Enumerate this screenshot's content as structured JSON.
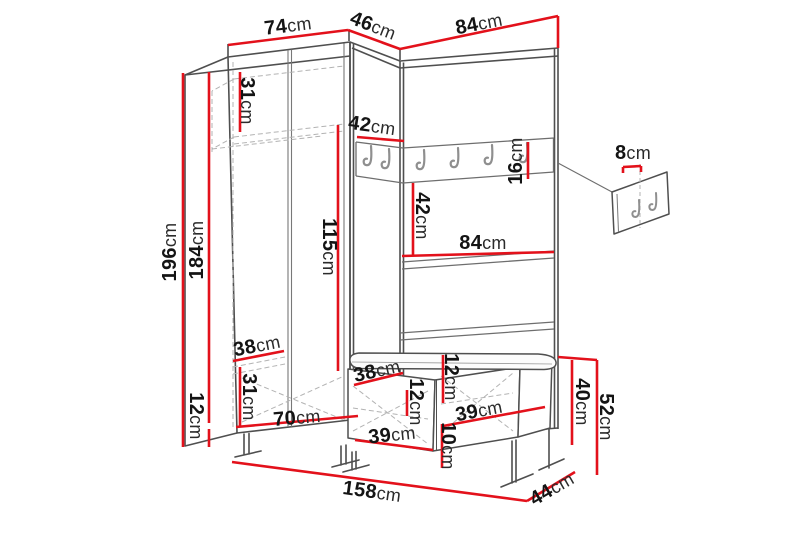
{
  "diagram": {
    "kind": "furniture-dimension-drawing",
    "subject": "hallway wardrobe set with coat rack, shelves and bench",
    "unit": "cm"
  },
  "colors": {
    "dimension_line": "#e3111b",
    "outline": "#4f4f4f",
    "inner_line": "#787878",
    "dashed_line": "#b3b3b3",
    "hook": "#8f8f8f",
    "label_text": "#141414",
    "background": "#ffffff"
  },
  "icons": {
    "coat_hook": "J-hook glyph",
    "rail_hook_count": 6,
    "wall_panel_hook_count": 2
  },
  "dimensions": [
    {
      "id": "wardrobe-width-top",
      "value": "74",
      "unit": "cm",
      "x": 288,
      "y": 26,
      "rot": -7
    },
    {
      "id": "corner-width-top",
      "value": "46",
      "unit": "cm",
      "x": 373,
      "y": 26,
      "rot": 21
    },
    {
      "id": "panel-width-top",
      "value": "84",
      "unit": "cm",
      "x": 479,
      "y": 24,
      "rot": -11
    },
    {
      "id": "upper-shelf-height",
      "value": "31",
      "unit": "cm",
      "x": 247,
      "y": 101,
      "rot": 90
    },
    {
      "id": "corner-rail-width",
      "value": "42",
      "unit": "cm",
      "x": 372,
      "y": 126,
      "rot": 8
    },
    {
      "id": "hook-rail-height",
      "value": "16",
      "unit": "cm",
      "x": 516,
      "y": 161,
      "rot": -90
    },
    {
      "id": "wall-panel-height",
      "value": "8",
      "unit": "cm",
      "x": 633,
      "y": 153,
      "rot": 0
    },
    {
      "id": "rail-to-shelf-height",
      "value": "42",
      "unit": "cm",
      "x": 422,
      "y": 216,
      "rot": 90
    },
    {
      "id": "shelf-width",
      "value": "84",
      "unit": "cm",
      "x": 483,
      "y": 243,
      "rot": 0
    },
    {
      "id": "hanging-space-height",
      "value": "115",
      "unit": "cm",
      "x": 329,
      "y": 247,
      "rot": 90
    },
    {
      "id": "total-height",
      "value": "196",
      "unit": "cm",
      "x": 170,
      "y": 252,
      "rot": -90
    },
    {
      "id": "body-height",
      "value": "184",
      "unit": "cm",
      "x": 197,
      "y": 250,
      "rot": -90
    },
    {
      "id": "wardrobe-shelf-depth",
      "value": "38",
      "unit": "cm",
      "x": 257,
      "y": 346,
      "rot": -11
    },
    {
      "id": "lower-compartment-height",
      "value": "31",
      "unit": "cm",
      "x": 249,
      "y": 397,
      "rot": 90
    },
    {
      "id": "wardrobe-inner-width",
      "value": "70",
      "unit": "cm",
      "x": 297,
      "y": 418,
      "rot": -5
    },
    {
      "id": "leg-height",
      "value": "12",
      "unit": "cm",
      "x": 196,
      "y": 416,
      "rot": 90
    },
    {
      "id": "bench-seat-depth",
      "value": "38",
      "unit": "cm",
      "x": 377,
      "y": 371,
      "rot": -13
    },
    {
      "id": "bench-top-height",
      "value": "12",
      "unit": "cm",
      "x": 451,
      "y": 377,
      "rot": 90
    },
    {
      "id": "bench-drawer-height",
      "value": "12",
      "unit": "cm",
      "x": 416,
      "y": 402,
      "rot": 90
    },
    {
      "id": "bench-door-right-width",
      "value": "39",
      "unit": "cm",
      "x": 479,
      "y": 411,
      "rot": -11
    },
    {
      "id": "bench-door-left-width",
      "value": "39",
      "unit": "cm",
      "x": 392,
      "y": 435,
      "rot": -6
    },
    {
      "id": "bench-plinth-height",
      "value": "10",
      "unit": "cm",
      "x": 448,
      "y": 446,
      "rot": 90
    },
    {
      "id": "bench-box-height",
      "value": "40",
      "unit": "cm",
      "x": 582,
      "y": 402,
      "rot": 90
    },
    {
      "id": "bench-total-height",
      "value": "52",
      "unit": "cm",
      "x": 606,
      "y": 417,
      "rot": 90
    },
    {
      "id": "total-width",
      "value": "158",
      "unit": "cm",
      "x": 372,
      "y": 492,
      "rot": 8
    },
    {
      "id": "total-depth",
      "value": "44",
      "unit": "cm",
      "x": 552,
      "y": 489,
      "rot": -30
    }
  ],
  "dimension_lines": [
    [
      228,
      45,
      348,
      30
    ],
    [
      348,
      30,
      400,
      49
    ],
    [
      400,
      49,
      558,
      16
    ],
    [
      558,
      16,
      558,
      48
    ],
    [
      183,
      73,
      183,
      447
    ],
    [
      209,
      72,
      209,
      423
    ],
    [
      209,
      429,
      209,
      447
    ],
    [
      240,
      72,
      240,
      132
    ],
    [
      357,
      137,
      404,
      141
    ],
    [
      528,
      142,
      528,
      179
    ],
    [
      623,
      167,
      641,
      166
    ],
    [
      623,
      167,
      623,
      173
    ],
    [
      641,
      166,
      641,
      172
    ],
    [
      413,
      183,
      413,
      255
    ],
    [
      402,
      256,
      554,
      252
    ],
    [
      338,
      125,
      338,
      371
    ],
    [
      233,
      361,
      284,
      351
    ],
    [
      240,
      367,
      240,
      427
    ],
    [
      236,
      427,
      358,
      416
    ],
    [
      354,
      385,
      403,
      373
    ],
    [
      443,
      355,
      443,
      403
    ],
    [
      407,
      390,
      407,
      416
    ],
    [
      443,
      426,
      545,
      407
    ],
    [
      442,
      424,
      442,
      468
    ],
    [
      355,
      440,
      433,
      450
    ],
    [
      572,
      360,
      572,
      445
    ],
    [
      597,
      360,
      597,
      475
    ],
    [
      558,
      357,
      597,
      360
    ],
    [
      232,
      462,
      527,
      501
    ],
    [
      527,
      501,
      575,
      472
    ]
  ]
}
